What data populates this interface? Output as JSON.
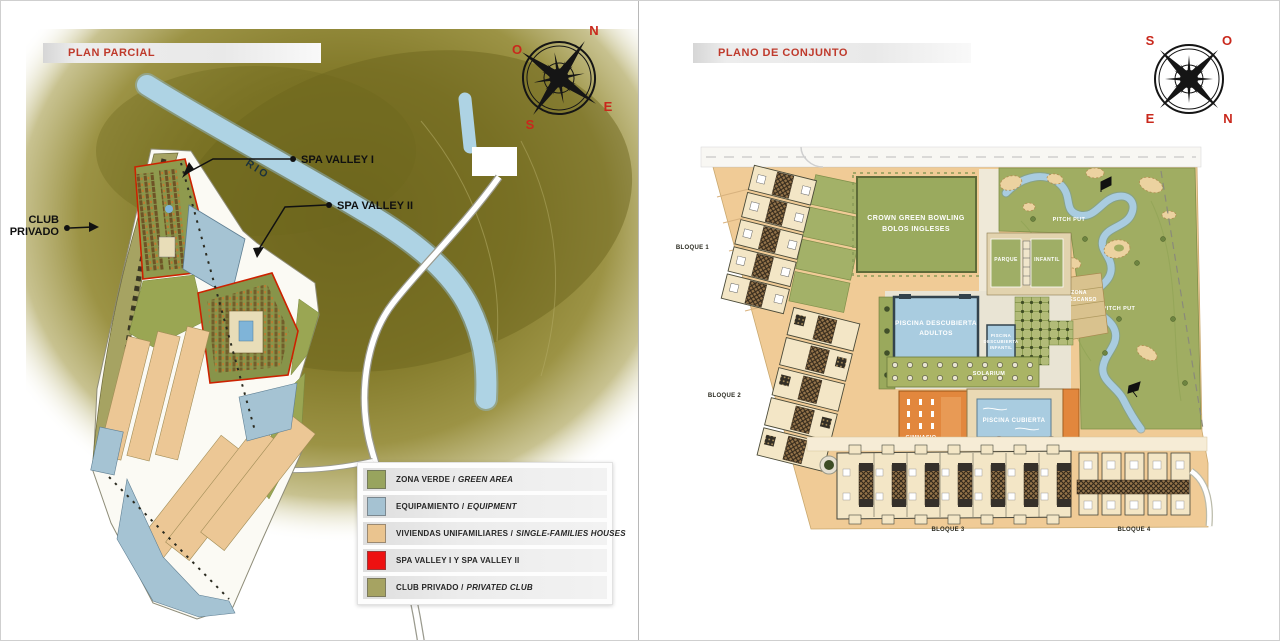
{
  "left_panel": {
    "title": "PLAN PARCIAL",
    "compass": {
      "top_left": "O",
      "top_right": "N",
      "bottom_left": "S",
      "bottom_right": "E"
    },
    "map_labels": {
      "rio": "RIO",
      "spa_valley_1": "SPA VALLEY I",
      "spa_valley_2": "SPA VALLEY II",
      "club_line1": "CLUB",
      "club_line2": "PRIVADO"
    },
    "legend": {
      "items": [
        {
          "text": "ZONA VERDE /",
          "text_italic": "GREEN AREA",
          "color": "#98a45e"
        },
        {
          "text": "EQUIPAMIENTO /",
          "text_italic": "EQUIPMENT",
          "color": "#a5c2d2"
        },
        {
          "text": "VIVIENDAS UNIFAMILIARES /",
          "text_italic": "SINGLE-FAMILIES HOUSES",
          "color": "#eac48f"
        },
        {
          "text": "SPA VALLEY I Y SPA VALLEY II",
          "text_italic": "",
          "color": "#ee1111"
        },
        {
          "text": "CLUB PRIVADO /",
          "text_italic": "PRIVATED CLUB",
          "color": "#a6a362"
        }
      ]
    }
  },
  "right_panel": {
    "title": "PLANO DE CONJUNTO",
    "compass": {
      "top_left": "S",
      "top_right": "O",
      "bottom_left": "E",
      "bottom_right": "N"
    },
    "map_labels": {
      "bloque_1": "BLOQUE 1",
      "bloque_2": "BLOQUE 2",
      "bloque_3": "BLOQUE 3",
      "bloque_4": "BLOQUE 4",
      "bowling_line1": "CROWN GREEN BOWLING",
      "bowling_line2": "BOLOS INGLESES",
      "parque": "PARQUE",
      "infantil": "INFANTIL",
      "piscina_adultos_line1": "PISCINA DESCUBIERTA",
      "piscina_adultos_line2": "ADULTOS",
      "piscina_infantil_line1": "PISCINA",
      "piscina_infantil_line2": "DESCUBIERTA",
      "piscina_infantil_line3": "INFANTIL",
      "solarium": "SOLARIUM",
      "gimnasio": "GIMNASIO",
      "piscina_cubierta": "PISCINA CUBIERTA",
      "pitch_put": "PITCH PUT",
      "zona_descanso_line1": "ZONA",
      "zona_descanso_line2": "DESCANSO"
    }
  },
  "colors": {
    "title_red": "#bf3a2c",
    "terrain_olive": "#7d7526",
    "river_blue": "#aed3e4",
    "site_tan": "#f0cb96",
    "green_area": "#9aaa5e",
    "pool_blue": "#a9cce0",
    "building_orange": "#e2873d",
    "building_cream": "#f3e6c6",
    "spa_outline_red": "#cc2200",
    "club_khaki": "#a6a362"
  }
}
